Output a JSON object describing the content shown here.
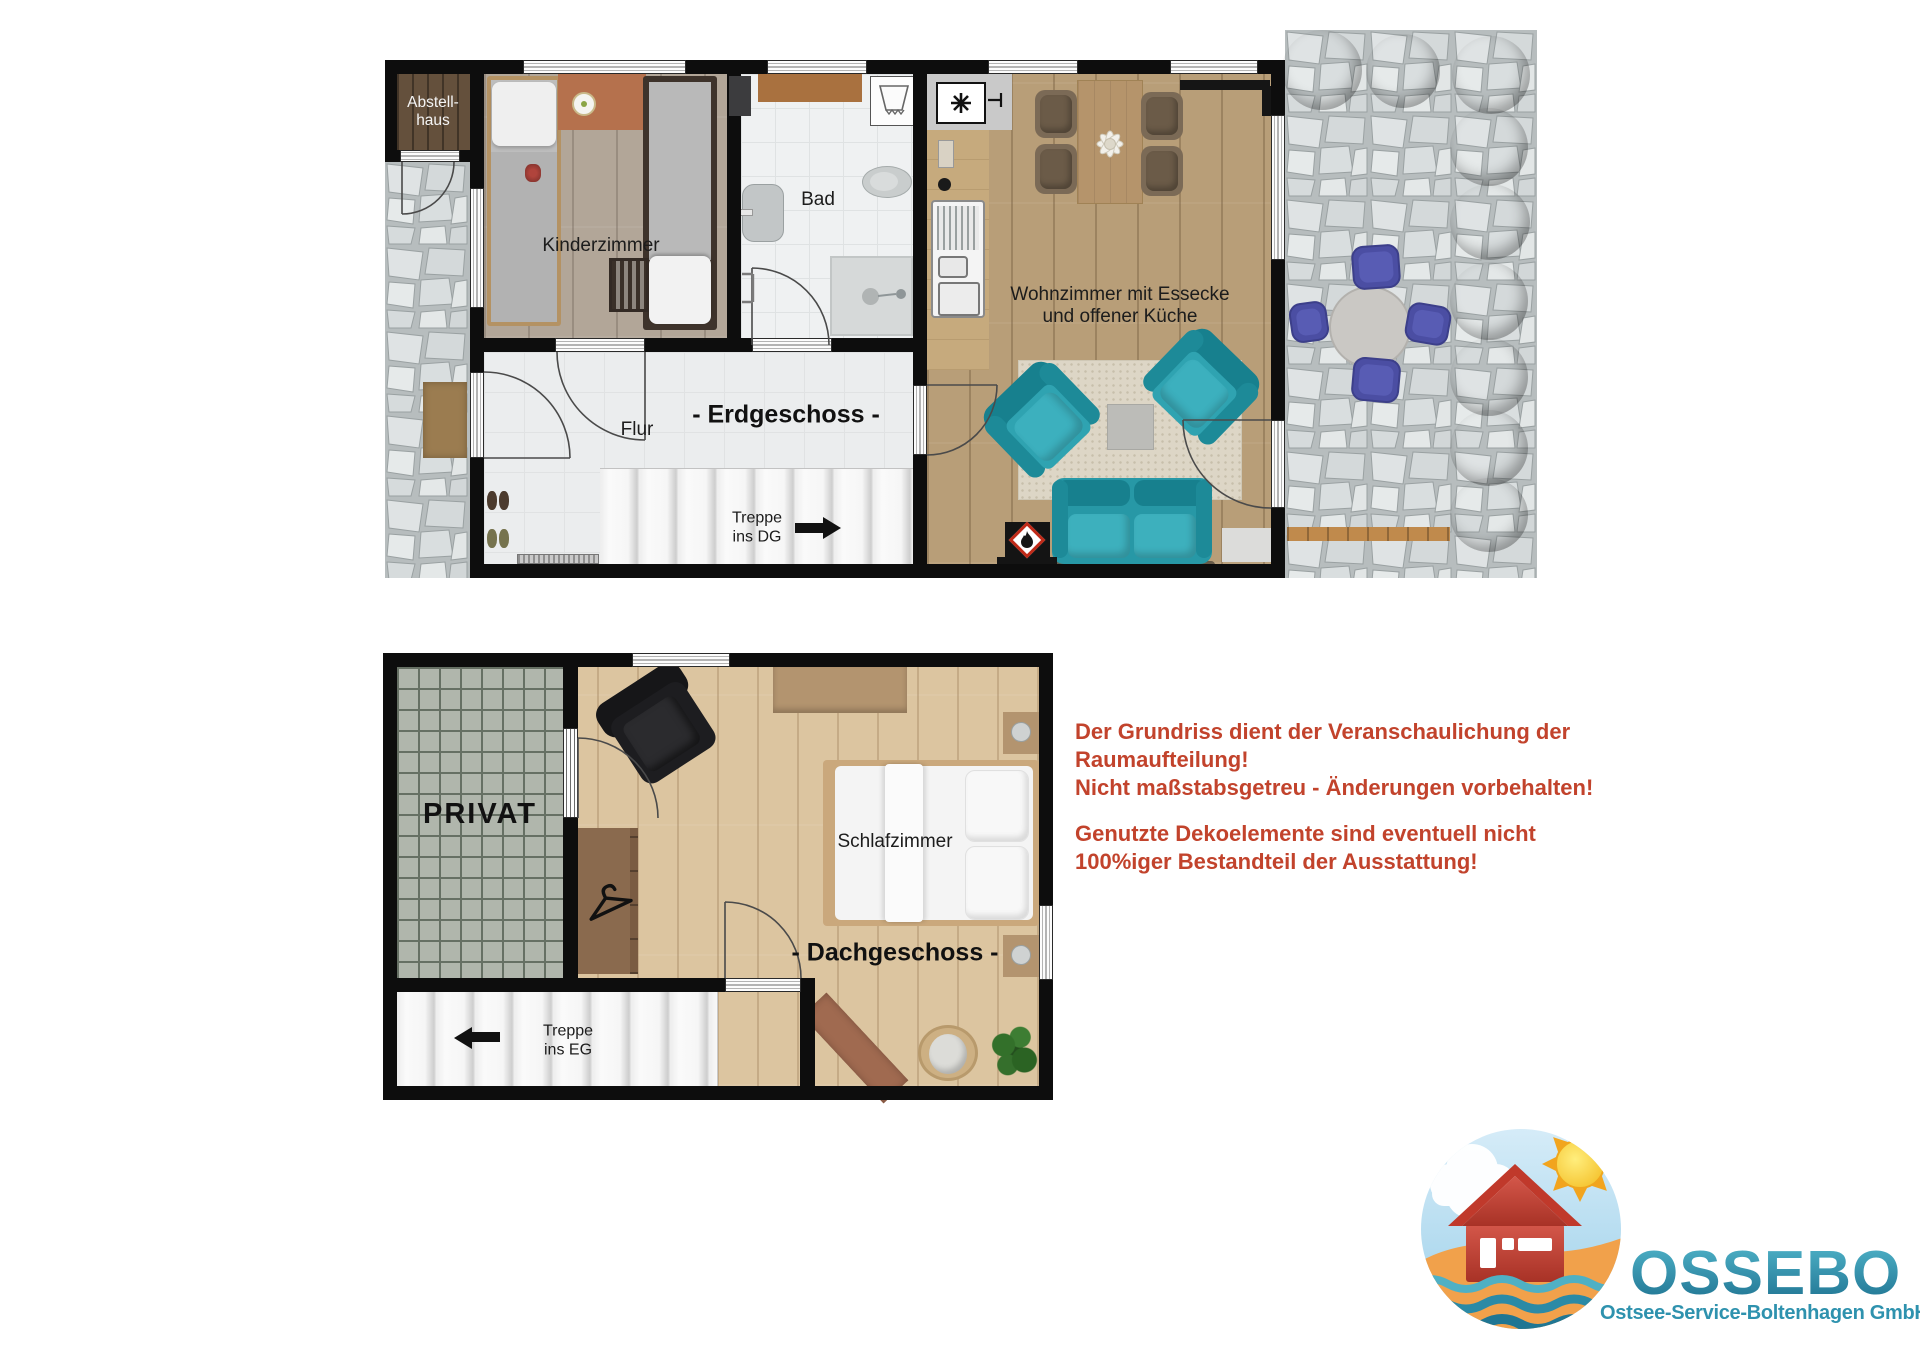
{
  "eg": {
    "title": "- Erdgeschoss -",
    "rooms": {
      "abstellhaus_line1": "Abstell-",
      "abstellhaus_line2": "haus",
      "kinderzimmer": "Kinderzimmer",
      "bad": "Bad",
      "flur": "Flur",
      "wohnzimmer_line1": "Wohnzimmer mit Essecke",
      "wohnzimmer_line2": "und offener Küche"
    },
    "stairs": {
      "line1": "Treppe",
      "line2": "ins DG",
      "arrow_direction": "right"
    }
  },
  "dg": {
    "title": "- Dachgeschoss -",
    "rooms": {
      "privat": "PRIVAT",
      "schlafzimmer": "Schlafzimmer"
    },
    "stairs": {
      "line1": "Treppe",
      "line2": "ins EG",
      "arrow_direction": "left"
    }
  },
  "disclaimer": {
    "text_color": "#c2432c",
    "p1_line1": "Der Grundriss dient der Veranschaulichung der",
    "p1_line2": "Raumaufteilung!",
    "p1_line3": "Nicht maßstabsgetreu - Änderungen vorbehalten!",
    "p2_line1": "Genutzte Dekoelemente sind eventuell nicht",
    "p2_line2": "100%iger Bestandteil der Ausstattung!"
  },
  "logo": {
    "company": "OSSEBO",
    "subtitle": "Ostsee-Service-Boltenhagen GmbH",
    "brand_color": "#2e92ae"
  },
  "palette": {
    "wall": "#0d0d0d",
    "teal_furniture": "#2fa3b1",
    "garden_chair_blue": "#4b4ea3",
    "stone": "#c6cbcc",
    "wood_attic": "#dcc5a0",
    "wood_living": "#b89e78",
    "disclaimer_red": "#c2432c"
  }
}
